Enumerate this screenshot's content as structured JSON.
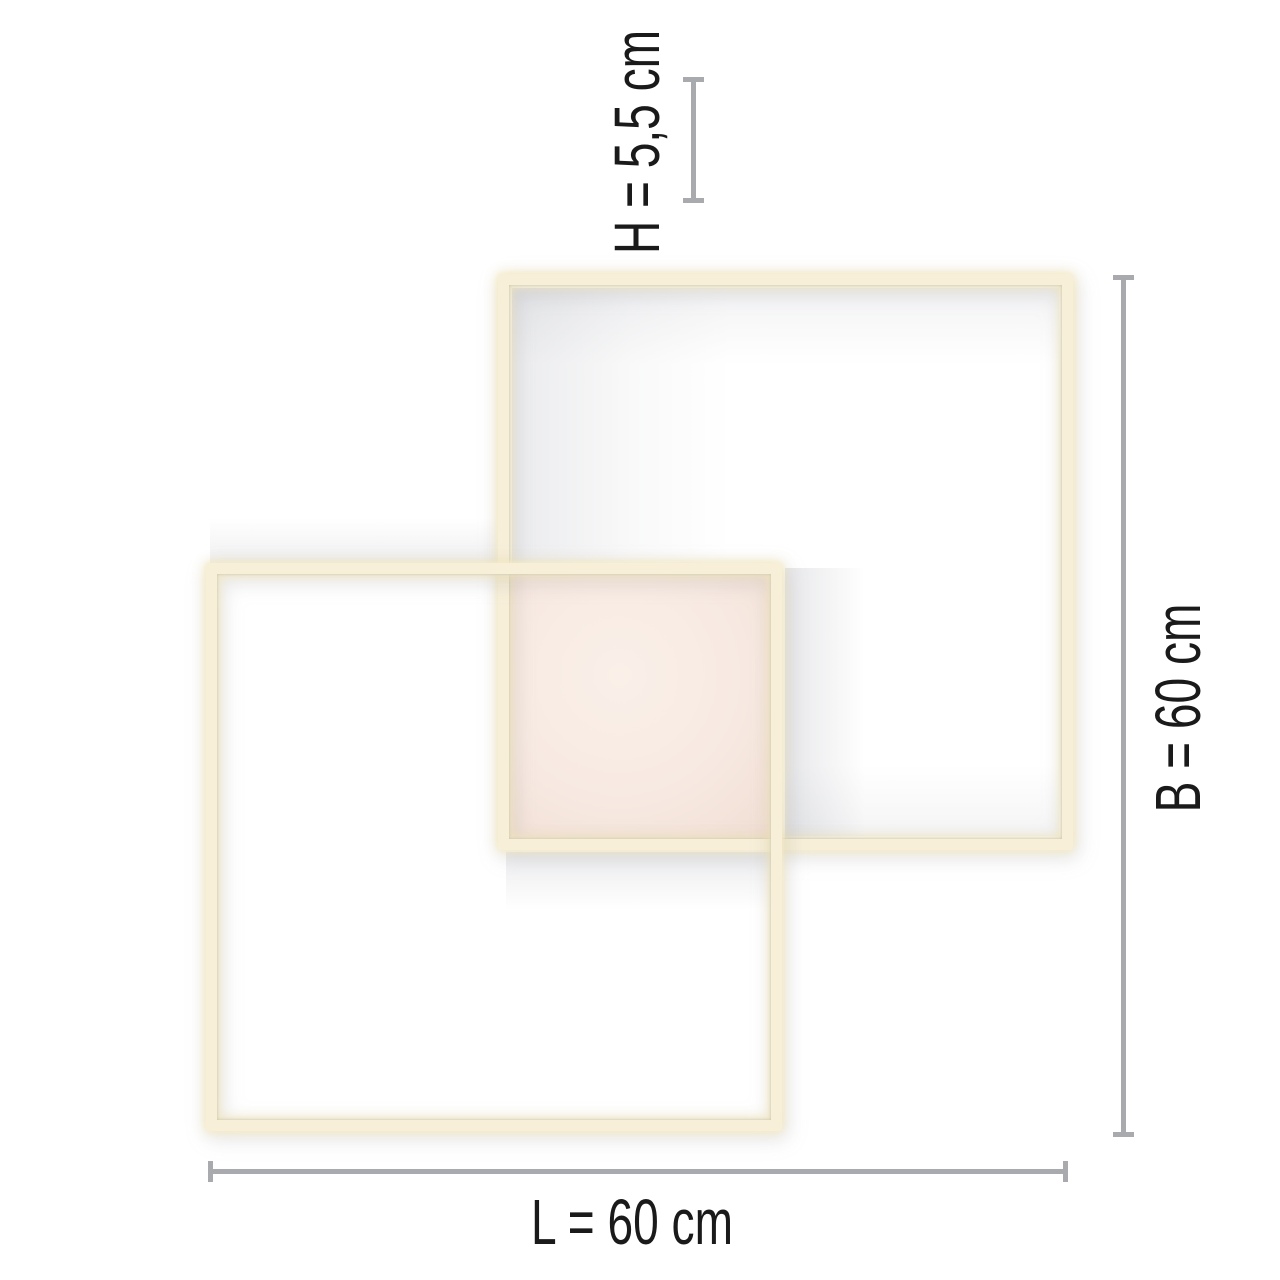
{
  "diagram": {
    "type": "product-dimension-diagram",
    "subject": "ceiling light with two overlapping square LED frames and center panel",
    "dimensions": {
      "height": {
        "label": "H = 5,5 cm",
        "value_cm": 5.5,
        "axis": "vertical-top"
      },
      "width": {
        "label": "B = 60 cm",
        "value_cm": 60,
        "axis": "vertical-right"
      },
      "length": {
        "label": "L = 60 cm",
        "value_cm": 60,
        "axis": "horizontal-bottom"
      }
    },
    "colors": {
      "background": "#ffffff",
      "frame_led": "#f7efd8",
      "frame_glow": "#f2e5b6",
      "center_panel": "#f7e9e1",
      "dimension_line": "#a9aaae",
      "label_text": "#1a1a1a"
    }
  }
}
